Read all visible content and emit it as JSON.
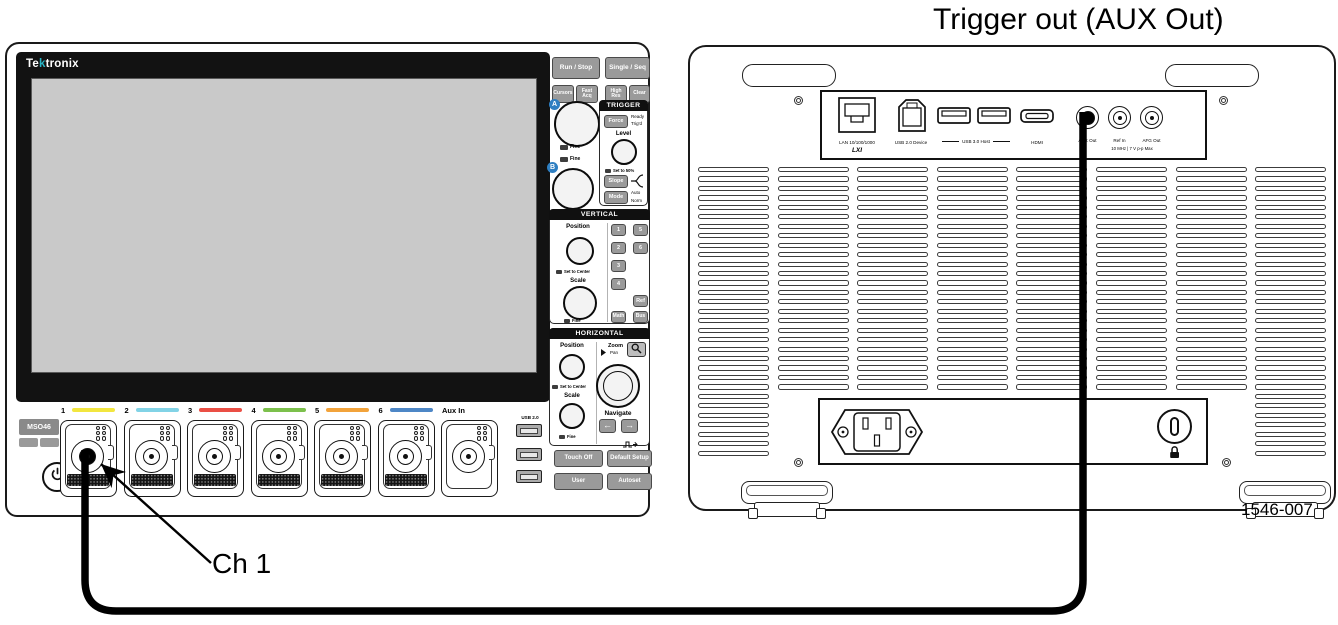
{
  "title": "Trigger out (AUX Out)",
  "figure_number": "1546-007",
  "callout": {
    "label": "Ch 1"
  },
  "colors": {
    "logo_accent": "#29b6c6",
    "knob_badge_blue": "#2e7fc2",
    "ch1_yellow": "#f2e63f",
    "ch2_cyan": "#82d3e6",
    "ch3_red": "#ea4f45",
    "ch4_green": "#7cc04c",
    "ch5_orange": "#f2a33b",
    "ch6_blue": "#4e87c6"
  },
  "front": {
    "brand": {
      "pre": "Te",
      "accent": "k",
      "post": "tronix"
    },
    "model": "MSO46",
    "top_buttons": {
      "run_stop": "Run / Stop",
      "single_seq": "Single / Seq",
      "cursors": "Cursors",
      "fast_acq": "Fast Acq",
      "high_res": "High Res",
      "clear": "Clear"
    },
    "knobs": {
      "a": "A",
      "b": "B",
      "fine": "Fine"
    },
    "trigger": {
      "header": "TRIGGER",
      "force": "Force",
      "ready": "Ready",
      "trigd": "Trig'd",
      "level": "Level",
      "set_50": "Set to 50%",
      "slope": "Slope",
      "mode": "Mode",
      "auto": "Auto",
      "norm": "Norm"
    },
    "vertical": {
      "header": "VERTICAL",
      "position": "Position",
      "set_to_center": "Set to Center",
      "scale": "Scale",
      "fine": "Fine",
      "buttons": [
        "1",
        "5",
        "2",
        "6",
        "3",
        "4"
      ],
      "ref": "Ref",
      "math": "Math",
      "bus": "Bus"
    },
    "horizontal": {
      "header": "HORIZONTAL",
      "position": "Position",
      "set_to_center": "Set to Center",
      "scale": "Scale",
      "fine": "Fine",
      "zoom": "Zoom",
      "pan": "Pan",
      "navigate": "Navigate",
      "arrow_left": "←",
      "arrow_right": "→"
    },
    "bottom_buttons": {
      "touch_off": "Touch Off",
      "default_setup": "Default Setup",
      "user": "User",
      "autoset": "Autoset"
    },
    "channels": [
      {
        "label": "1",
        "color": "#f2e63f",
        "plugged": true
      },
      {
        "label": "2",
        "color": "#82d3e6"
      },
      {
        "label": "3",
        "color": "#ea4f45"
      },
      {
        "label": "4",
        "color": "#7cc04c"
      },
      {
        "label": "5",
        "color": "#f2a33b"
      },
      {
        "label": "6",
        "color": "#4e87c6"
      },
      {
        "label": "Aux In",
        "color": null,
        "strip": false
      }
    ],
    "usb_label": "USB 2.0"
  },
  "rear": {
    "lan_label": "LAN 10/100/1000",
    "lxi": "LXI",
    "usb_device_label": "USB 2.0 Device",
    "usb_host_label": "USB 3.0 Host",
    "hdmi_label": "HDMI",
    "aux_out_label": "AUX Out",
    "ref_in_label": "Ref In",
    "afg_out_label": "AFG Out",
    "ref_spec": "10 MHz | 7 V p-p Max"
  }
}
